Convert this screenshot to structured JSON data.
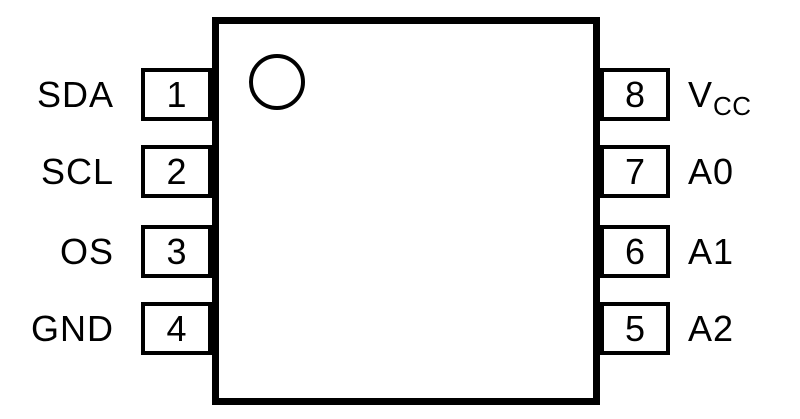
{
  "diagram": {
    "title": "8-pin IC package pinout (top view)",
    "colors": {
      "line": "#000000",
      "background": "#ffffff"
    },
    "pin1_marker": "orientation-dot",
    "pins": {
      "left": [
        {
          "number": "1",
          "label": "SDA"
        },
        {
          "number": "2",
          "label": "SCL"
        },
        {
          "number": "3",
          "label": "OS"
        },
        {
          "number": "4",
          "label": "GND"
        }
      ],
      "right": [
        {
          "number": "8",
          "label": "V",
          "label_sub": "CC"
        },
        {
          "number": "7",
          "label": "A0",
          "label_sub": ""
        },
        {
          "number": "6",
          "label": "A1",
          "label_sub": ""
        },
        {
          "number": "5",
          "label": "A2",
          "label_sub": ""
        }
      ]
    }
  }
}
